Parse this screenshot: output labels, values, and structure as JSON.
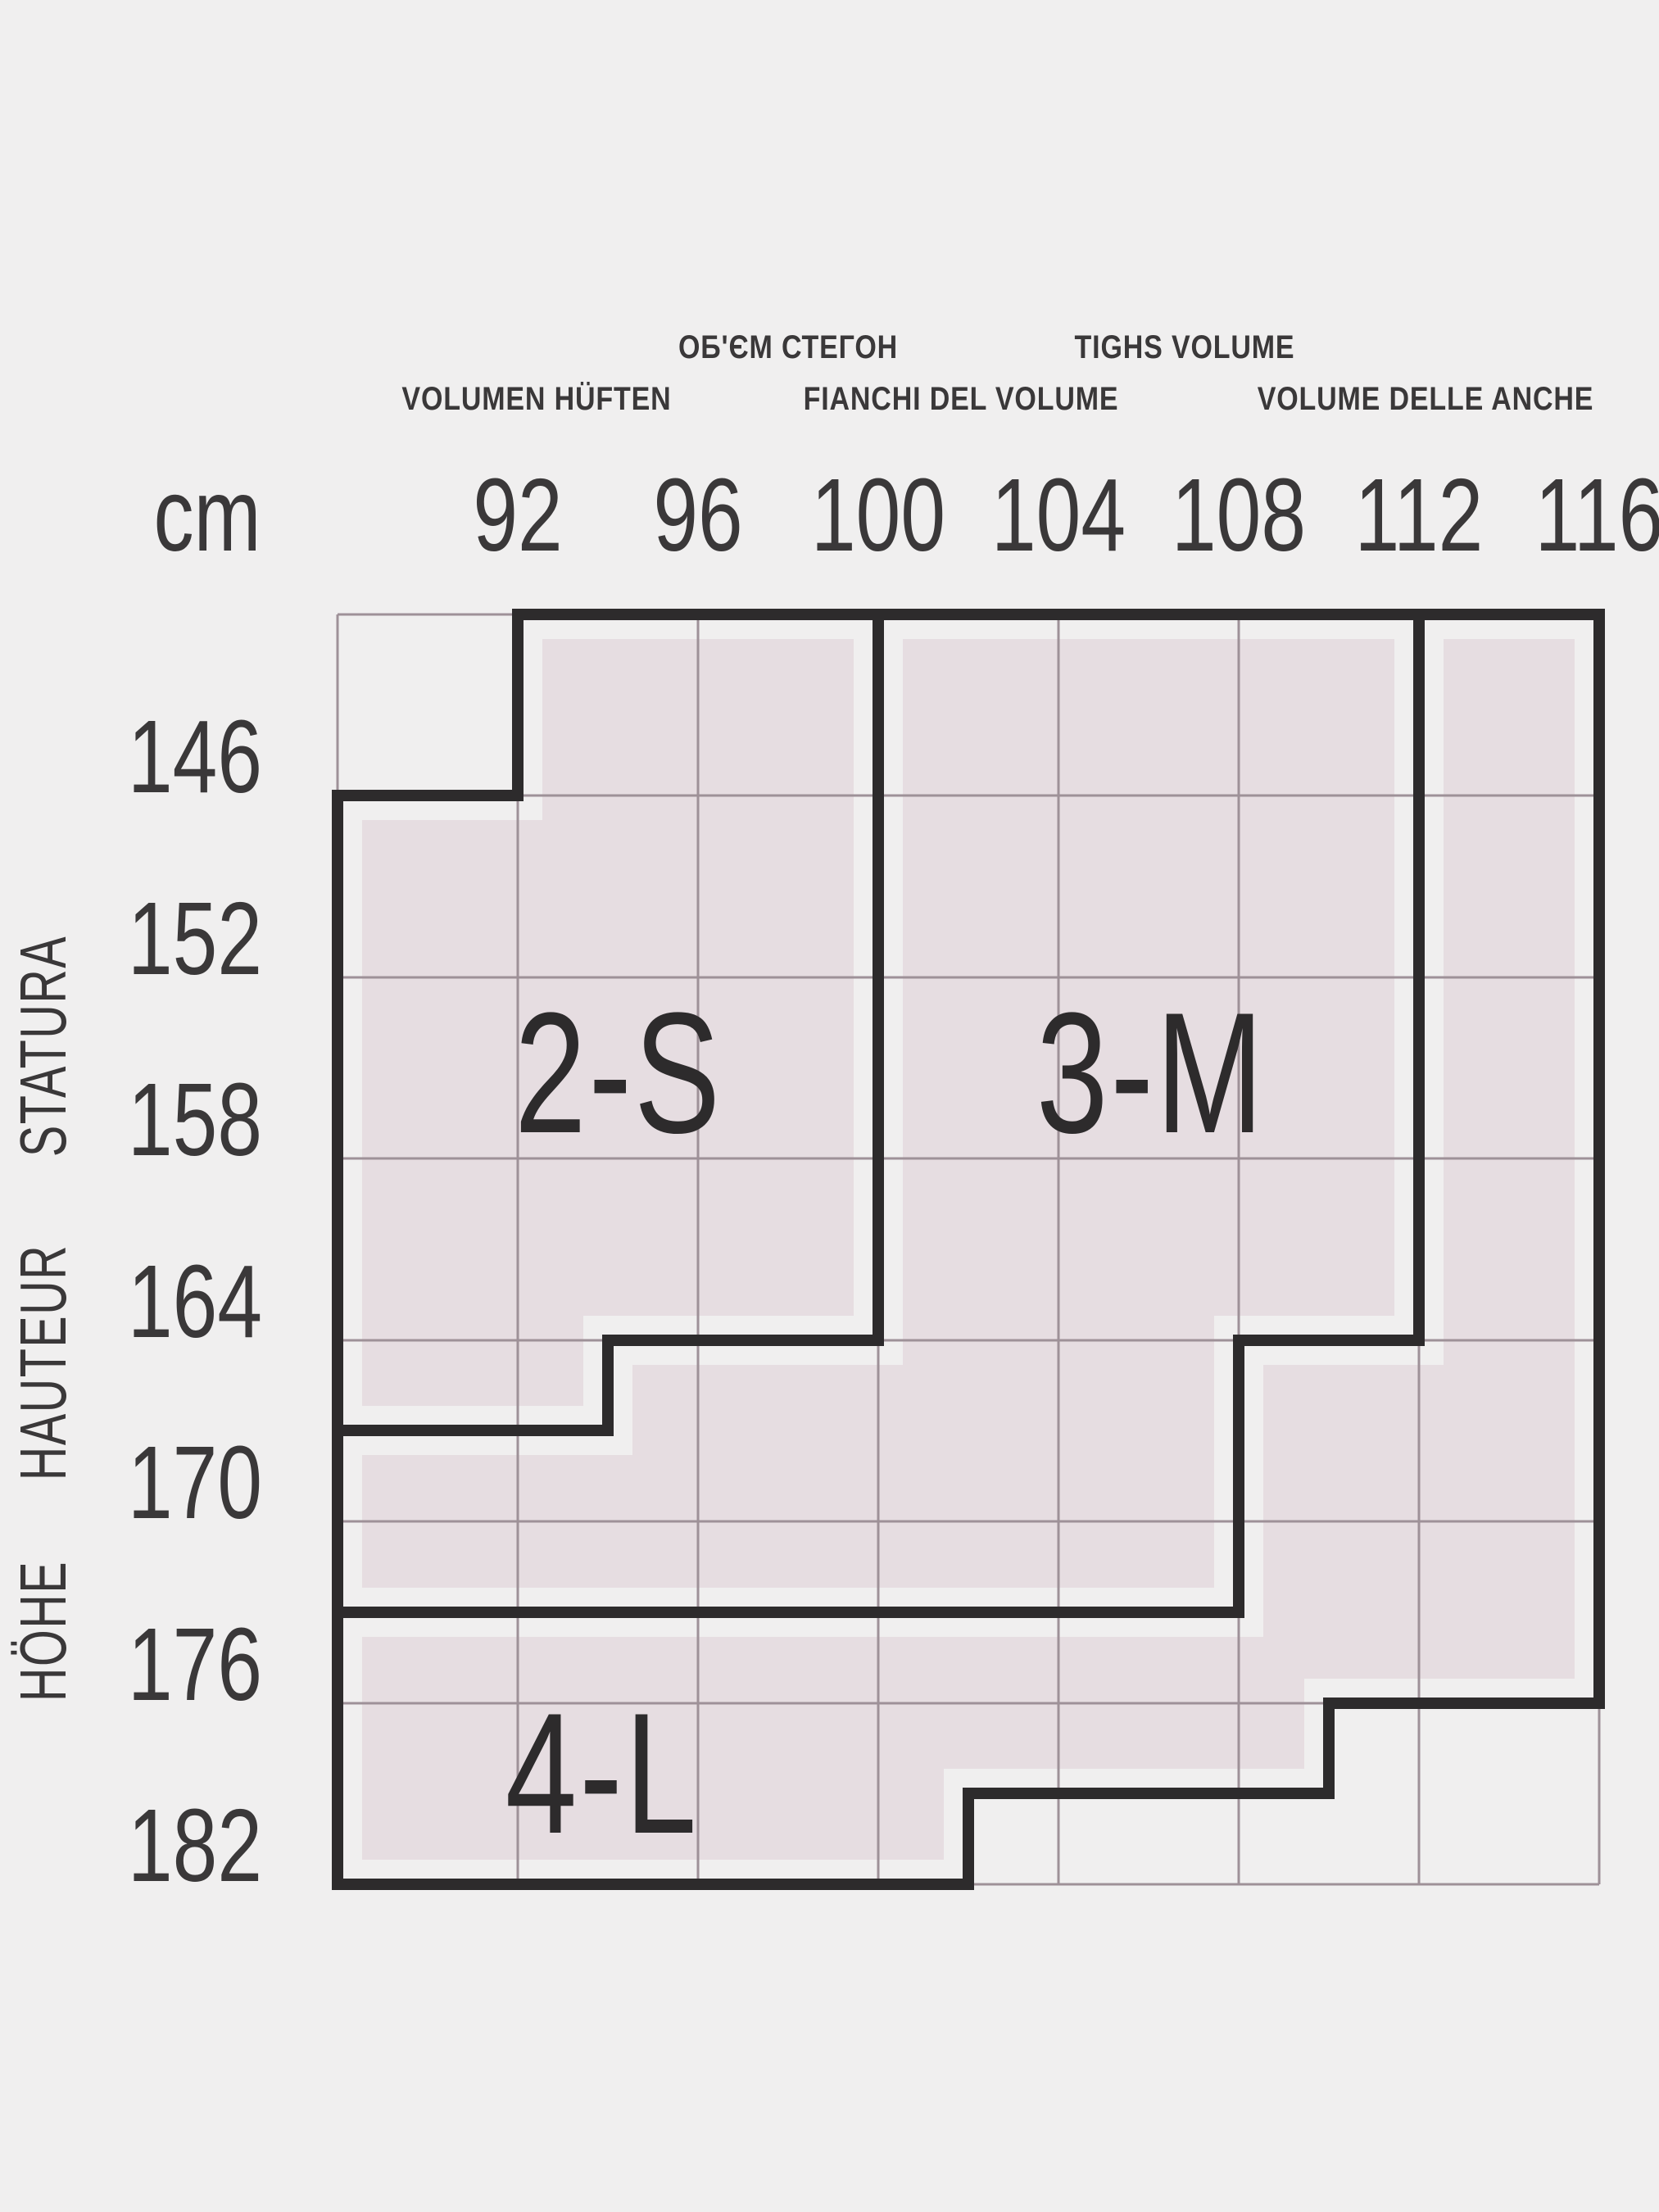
{
  "title": "Tights size chart",
  "colors": {
    "background": "#f0efef",
    "region_fill": "#e6dde1",
    "grid_line": "#9e9198",
    "region_border": "#2d2b2c",
    "text": "#3a3839"
  },
  "header": {
    "row1": [
      "ОБ'ЄМ СТЕГОН",
      "TIGHS VOLUME"
    ],
    "row2": [
      "VOLUMEN HÜFTEN",
      "FIANCHI DEL VOLUME",
      "VOLUME DELLE ANCHE"
    ],
    "unit": "cm"
  },
  "x_axis": {
    "values": [
      "92",
      "96",
      "100",
      "104",
      "108",
      "112",
      "116"
    ]
  },
  "y_axis": {
    "values": [
      "146",
      "152",
      "158",
      "164",
      "170",
      "176",
      "182"
    ],
    "words": [
      "STATURA",
      "HAUTEUR",
      "HÖHE"
    ]
  },
  "regions": [
    {
      "label": "2-S"
    },
    {
      "label": "3-M"
    },
    {
      "label": "4-L"
    }
  ],
  "chart_data": {
    "type": "table",
    "title": "Hosiery size selection chart: hip/thigh volume vs body height",
    "x_axis": {
      "unit": "cm",
      "label_lines": [
        "ОБ'ЄМ СТЕГОН / TIGHS VOLUME",
        "VOLUMEN HÜFTEN / FIANCHI DEL VOLUME / VOLUME DELLE ANCHE"
      ],
      "ticks": [
        92,
        96,
        100,
        104,
        108,
        112,
        116
      ]
    },
    "y_axis": {
      "unit": "cm",
      "label": "STATURA / HAUTEUR / HÖHE",
      "ticks": [
        146,
        152,
        158,
        164,
        170,
        176,
        182
      ]
    },
    "grid": {
      "columns": 7,
      "rows": 7,
      "grid_on": true
    },
    "regions": [
      {
        "size": "2-S",
        "polygon_cm_height": [
          [
            92,
            140
          ],
          [
            100,
            140
          ],
          [
            100,
            164
          ],
          [
            94,
            164
          ],
          [
            94,
            167
          ],
          [
            88,
            167
          ],
          [
            88,
            146
          ],
          [
            92,
            146
          ]
        ]
      },
      {
        "size": "3-M",
        "polygon_cm_height": [
          [
            100,
            140
          ],
          [
            112,
            140
          ],
          [
            112,
            164
          ],
          [
            108,
            164
          ],
          [
            108,
            173
          ],
          [
            88,
            173
          ],
          [
            88,
            167
          ],
          [
            94,
            167
          ],
          [
            94,
            164
          ],
          [
            100,
            164
          ]
        ]
      },
      {
        "size": "4-L",
        "polygon_cm_height": [
          [
            112,
            140
          ],
          [
            116,
            140
          ],
          [
            116,
            176
          ],
          [
            110,
            176
          ],
          [
            110,
            179
          ],
          [
            102,
            179
          ],
          [
            102,
            182
          ],
          [
            88,
            182
          ],
          [
            88,
            173
          ],
          [
            108,
            173
          ],
          [
            108,
            164
          ],
          [
            112,
            164
          ]
        ]
      }
    ]
  }
}
